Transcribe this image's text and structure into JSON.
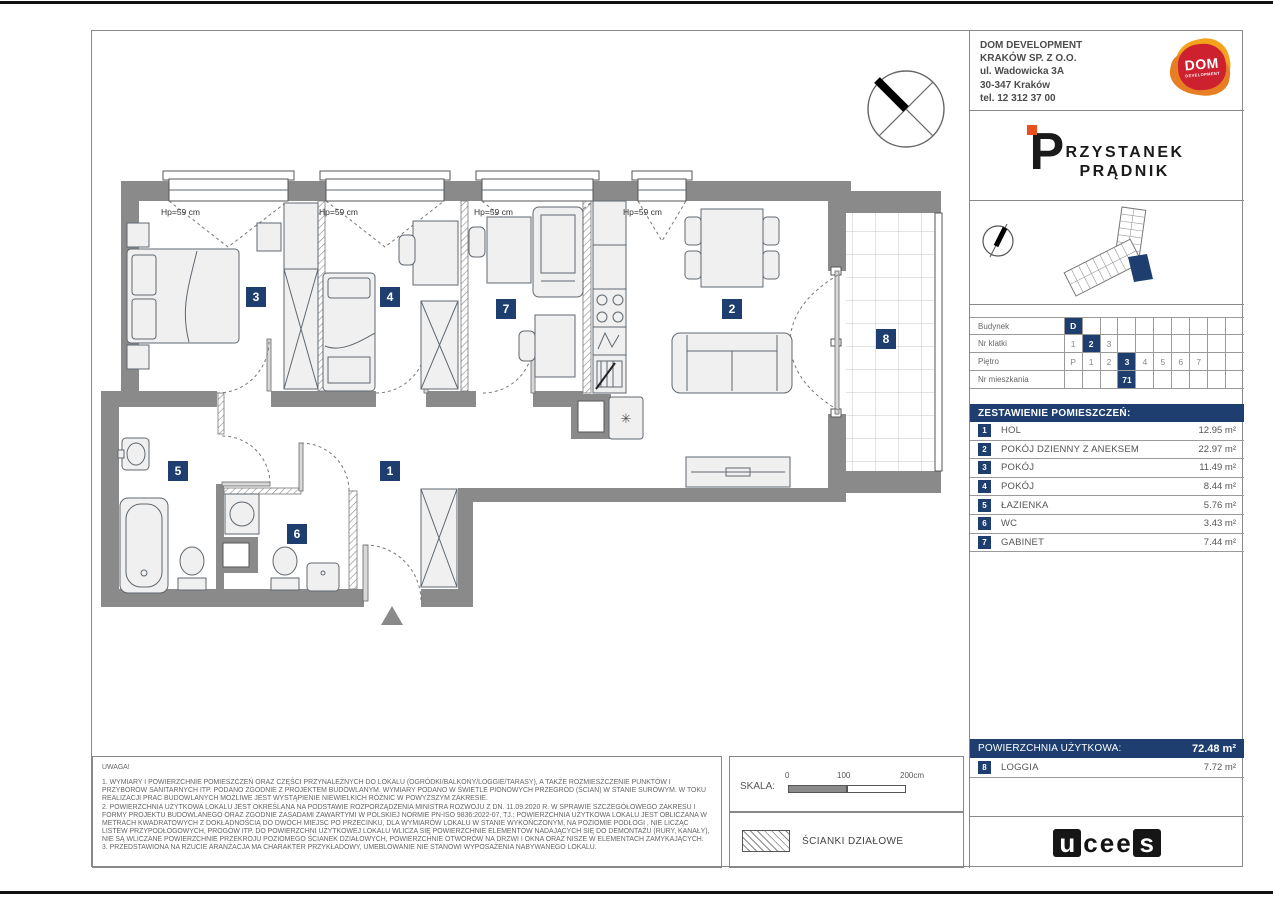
{
  "colors": {
    "navy": "#1d3e6e",
    "wall_gray": "#8a8a8a",
    "dom_red": "#cd2130",
    "dom_orange": "#f3a21c",
    "pp_orange": "#e8501e"
  },
  "developer": {
    "name_line1": "DOM DEVELOPMENT",
    "name_line2": "KRAKÓW SP. Z O.O.",
    "address_line1": "ul. Wadowicka 3A",
    "address_line2": "30-347 Kraków",
    "phone": "tel. 12 312 37 00",
    "logo_text": "DOM",
    "logo_subtext": "DEVELOPMENT"
  },
  "project": {
    "logo_first_letter": "P",
    "logo_rest": "RZYSTANEK",
    "logo_second_line": "PRĄDNIK"
  },
  "unit_info": {
    "rows": [
      {
        "label": "Budynek",
        "cells": [
          "D",
          "",
          "",
          "",
          "",
          "",
          "",
          "",
          "",
          ""
        ],
        "highlight": 0
      },
      {
        "label": "Nr klatki",
        "cells": [
          "1",
          "2",
          "3",
          "",
          "",
          "",
          "",
          "",
          "",
          ""
        ],
        "highlight": 1
      },
      {
        "label": "Piętro",
        "cells": [
          "P",
          "1",
          "2",
          "3",
          "4",
          "5",
          "6",
          "7",
          "",
          ""
        ],
        "highlight": 3
      },
      {
        "label": "Nr mieszkania",
        "cells": [
          "",
          "",
          "",
          "71",
          "",
          "",
          "",
          "",
          "",
          ""
        ],
        "highlight": 3
      }
    ]
  },
  "rooms": {
    "header": "ZESTAWIENIE POMIESZCZEŃ:",
    "items": [
      {
        "no": "1",
        "name": "HOL",
        "area": "12.95 m²"
      },
      {
        "no": "2",
        "name": "POKÓJ DZIENNY Z ANEKSEM",
        "area": "22.97 m²"
      },
      {
        "no": "3",
        "name": "POKÓJ",
        "area": "11.49 m²"
      },
      {
        "no": "4",
        "name": "POKÓJ",
        "area": "8.44 m²"
      },
      {
        "no": "5",
        "name": "ŁAZIENKA",
        "area": "5.76 m²"
      },
      {
        "no": "6",
        "name": "WC",
        "area": "3.43 m²"
      },
      {
        "no": "7",
        "name": "GABINET",
        "area": "7.44 m²"
      }
    ]
  },
  "summary": {
    "label": "POWIERZCHNIA UŻYTKOWA:",
    "value": "72.48 m²",
    "loggia_no": "8",
    "loggia_name": "LOGGIA",
    "loggia_area": "7.72 m²"
  },
  "notes": {
    "title": "UWAGA!",
    "items": [
      "1. WYMIARY I POWIERZCHNIE POMIESZCZEŃ ORAZ CZĘŚCI PRZYNALEŻNYCH DO LOKALU (OGRÓDKI/BALKONY/LOGGIE/TARASY), A TAKŻE ROZMIESZCZENIE PUNKTÓW I PRZYBORÓW SANITARNYCH ITP. PODANO ZGODNIE Z PROJEKTEM BUDOWLANYM. WYMIARY PODANO W ŚWIETLE PIONOWYCH PRZEGRÓD (ŚCIAN) W STANIE SUROWYM. W TOKU REALIZACJI PRAC BUDOWLANYCH MOŻLIWE JEST WYSTĄPIENIE NIEWIELKICH RÓŻNIC W POWYŻSZYM ZAKRESIE.",
      "2. POWIERZCHNIA UŻYTKOWA LOKALU JEST OKREŚLANA NA PODSTAWIE ROZPORZĄDZENIA MINISTRA ROZWOJU Z DN. 11.09.2020 R. W SPRAWIE SZCZEGÓŁOWEGO ZAKRESU I FORMY PROJEKTU BUDOWLANEGO ORAZ ZGODNIE ZASADAMI ZAWARTYMI W POLSKIEJ NORMIE PN-ISO 9836:2022-07, TJ.: POWIERZCHNIA UŻYTKOWA LOKALU JEST OBLICZANA W METRACH KWADRATOWYCH Z DOKŁADNOŚCIĄ DO DWÓCH MIEJSC PO PRZECINKU, DLA WYMIARÓW LOKALU W STANIE WYKOŃCZONYM, NA POZIOMIE PODŁOGI , NIE LICZĄC LISTEW PRZYPODŁOGOWYCH, PROGÓW ITP. DO POWIERZCHNI UŻYTKOWEJ LOKALU WLICZA SIĘ POWIERZCHNIE ELEMENTÓW NADAJĄCYCH SIĘ DO DEMONTAŻU (RURY, KANAŁY), NIE SĄ WLICZANE POWIERZCHNIE PRZEKROJU POZIOMEGO ŚCIANEK DZIAŁOWYCH, POWIERZCHNIE OTWORÓW NA DRZWI I OKNA ORAZ NISZE W ELEMENTACH ZAMYKAJĄCYCH.",
      "3. PRZEDSTAWIONA NA RZUCIE ARANŻACJA MA CHARAKTER PRZYKŁADOWY, UMEBLOWANIE NIE STANOWI WYPOSAŻENIA NABYWANEGO LOKALU."
    ]
  },
  "scale": {
    "label": "SKALA:",
    "tick0": "0",
    "tick1": "100",
    "tick2": "200cm"
  },
  "legend": {
    "partition_label": "ŚCIANKI DZIAŁOWE"
  },
  "brand": {
    "letters": [
      {
        "ch": "u",
        "boxed": true
      },
      {
        "ch": "c",
        "boxed": false
      },
      {
        "ch": "e",
        "boxed": false
      },
      {
        "ch": "e",
        "boxed": false
      },
      {
        "ch": "s",
        "boxed": true
      }
    ]
  },
  "plan": {
    "window_label": "Hp=59 cm",
    "window_labels": [
      {
        "x": 69,
        "y": 176
      },
      {
        "x": 227,
        "y": 176
      },
      {
        "x": 382,
        "y": 176
      },
      {
        "x": 531,
        "y": 176
      }
    ],
    "badges": [
      {
        "no": "1",
        "x": 288,
        "y": 430
      },
      {
        "no": "2",
        "x": 630,
        "y": 268
      },
      {
        "no": "3",
        "x": 154,
        "y": 256
      },
      {
        "no": "4",
        "x": 288,
        "y": 256
      },
      {
        "no": "5",
        "x": 76,
        "y": 430
      },
      {
        "no": "6",
        "x": 195,
        "y": 493
      },
      {
        "no": "7",
        "x": 404,
        "y": 268
      },
      {
        "no": "8",
        "x": 784,
        "y": 298
      }
    ]
  }
}
